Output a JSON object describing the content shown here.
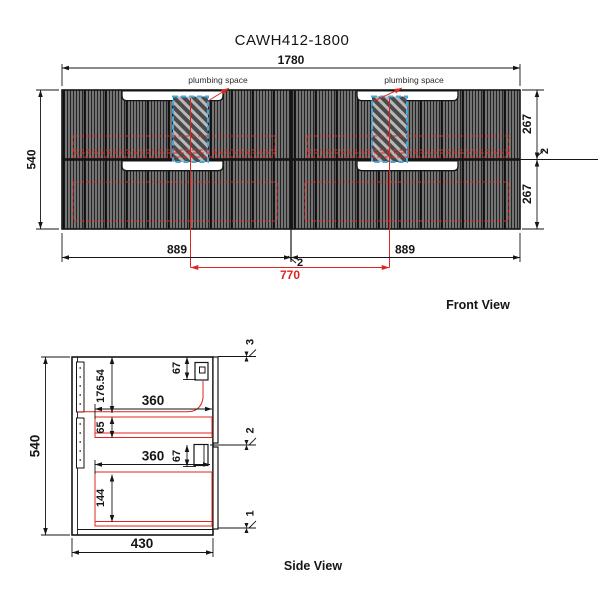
{
  "title": "CAWH412-1800",
  "colors": {
    "dimension_red": "#e02420",
    "plumbing_blue": "#3fa9e0",
    "line_black": "#151515",
    "cabinet_gray": "#5a5a5a"
  },
  "front_view": {
    "label": "Front View",
    "plumbing_label_left": "plumbing space",
    "plumbing_label_right": "plumbing space",
    "dims": {
      "overall_width": "1780",
      "overall_height": "540",
      "upper_drawer_height": "267",
      "right_gap": "2",
      "lower_drawer_height": "267",
      "left_half_width": "889",
      "center_gap": "2",
      "right_half_width": "889",
      "plumbing_centers": "770"
    }
  },
  "side_view": {
    "label": "Side View",
    "dims": {
      "overall_height": "540",
      "overall_depth": "430",
      "top_to_shelf": "176.54",
      "upper_bracket_offset": "67",
      "upper_drawer_depth": "360",
      "upper_interior_height": "65",
      "lower_bracket_offset": "67",
      "lower_drawer_depth": "360",
      "lower_interior_height": "144",
      "top_reveal": "3",
      "middle_reveal": "2",
      "bottom_reveal": "1"
    }
  }
}
